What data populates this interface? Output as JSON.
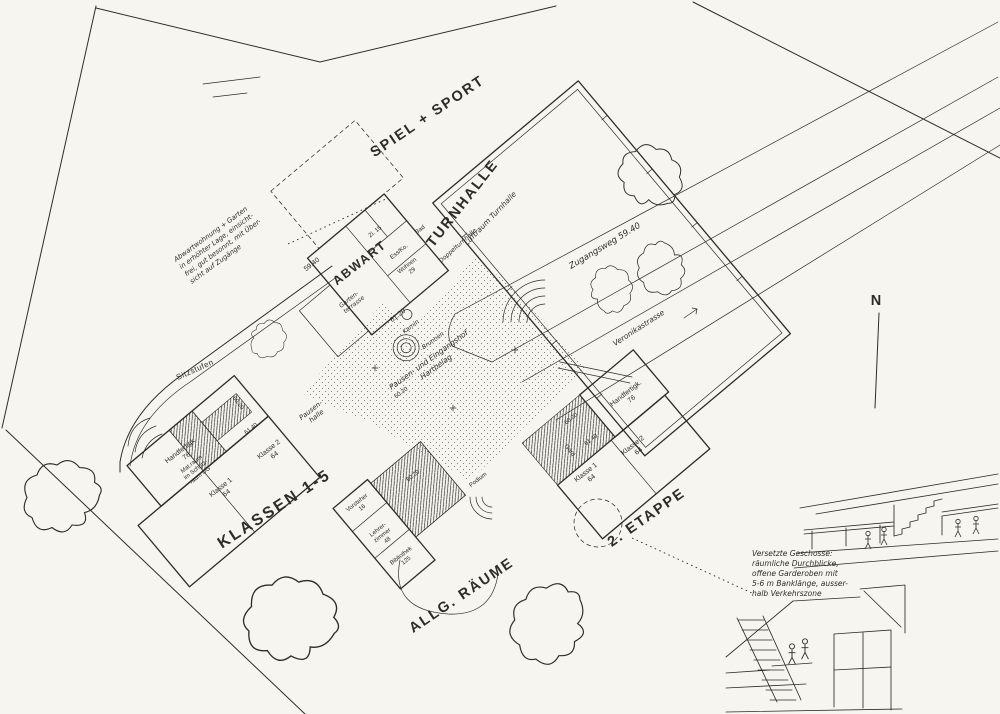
{
  "colors": {
    "ink": "#2e2c28",
    "paper": "#f6f5f0"
  },
  "areas": {
    "spiel_sport": "SPIEL + SPORT",
    "klassen": "KLASSEN 1-5",
    "allg": "ALLG. RÄUME",
    "etappe": "2. ETAPPE"
  },
  "gym": {
    "title": "TURNHALLE",
    "sub": "Luftraum Turnhalle",
    "wall": "Doppelturnhalle"
  },
  "abwart": {
    "title": "ABWART",
    "zi1": "Zi. 15",
    "essko": "Ess/Ko.",
    "wohnen": "Wohnen",
    "wohnen_area": "29",
    "bad": "Bad",
    "terrasse": [
      "Garten-",
      "terrasse"
    ],
    "kamin": "Kamin"
  },
  "left": {
    "handfertig": "Handfertigk.",
    "handfertig_area": "76",
    "mat": [
      "Mat.raum",
      "im Schutz-",
      "raum UG"
    ],
    "klasse1": "Klasse 1",
    "klasse1_area": "64",
    "klasse2": "Klasse 2",
    "klasse2_area": "64",
    "pausenhalle": [
      "Pausen-",
      "halle"
    ]
  },
  "right": {
    "handfertig": "Handfertigk.",
    "handfertig_area": "76",
    "klasse1": "Klasse 1",
    "klasse1_area": "64",
    "klasse2": "Klasse 2",
    "klasse2_area": "64",
    "gard": "Gard."
  },
  "admin": {
    "vorsteher": "Vorsteher",
    "vorsteher_area": "16",
    "lehrer": [
      "Lehrer-",
      "zimmer",
      "48"
    ],
    "bibliothek": "Bibliothek",
    "bibliothek_area": "125",
    "podium": "Podium"
  },
  "notes": {
    "abwart": [
      "Abwartwohnung + Garten",
      "in erhöhter Lage, einsicht-",
      "frei, gut besonnt, mit Über-",
      "sicht auf Zugänge"
    ],
    "courtyard": [
      "Pausen- und Eingangshof",
      "Hartbelag"
    ],
    "sections": [
      "Versetzte Geschosse:",
      "räumliche Durchblicke,",
      "offene Garderoben mit",
      "5-6 m Banklänge, ausser-",
      "halb Verkehrszone"
    ]
  },
  "paths": {
    "zugangsweg": "Zugangsweg  59.40",
    "strasse": "Veronikastrasse",
    "sitzstufen": "Sitzstufen",
    "brunnen": "Brunnen"
  },
  "elev": {
    "e1": "59.40",
    "e2": "61.20",
    "e3": "60.20",
    "e4": "61.40",
    "e5": "60.20",
    "e6": "60.20",
    "e7": "61.40",
    "e8": "60.20"
  },
  "compass": {
    "north": "N"
  }
}
